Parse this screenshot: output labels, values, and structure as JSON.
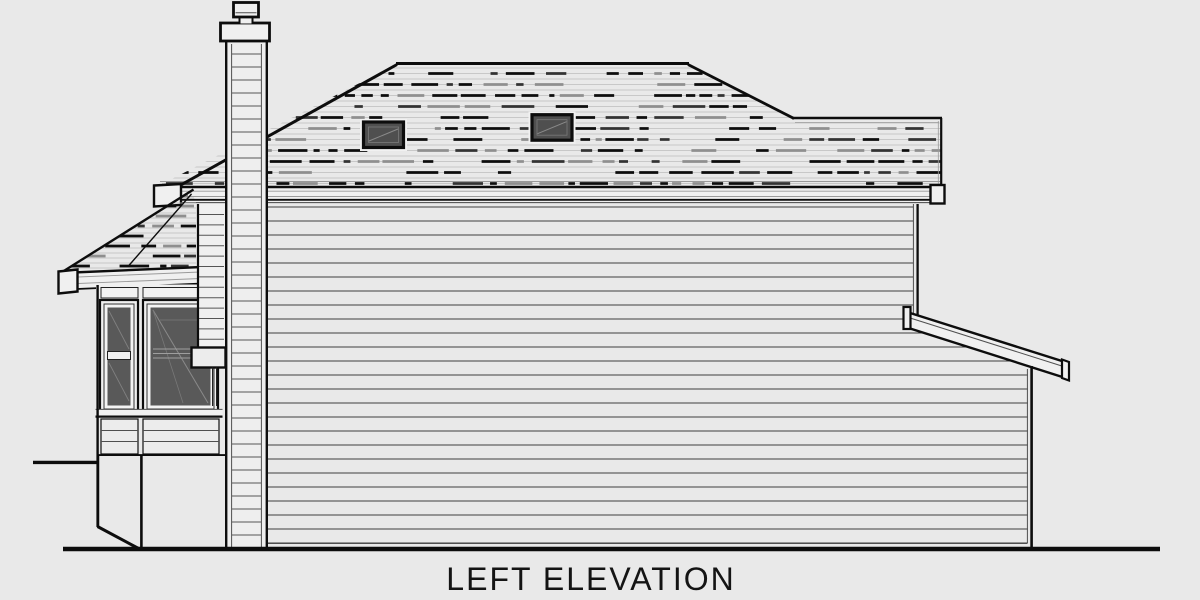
{
  "title": {
    "label": "LEFT ELEVATION"
  },
  "drawing": {
    "type": "architectural-house-side-elevation",
    "elements": [
      "chimney",
      "chimney-cap",
      "chimney-crown",
      "main-hip-roof",
      "roof-shingle-texture",
      "skylight-left",
      "skylight-right",
      "roof-fascia",
      "two-story-siding-wall",
      "bay-window-roof",
      "bay-window",
      "bay-window-left-sash",
      "bay-window-right-sash",
      "downspout-chase",
      "collector-box",
      "rear-shed-roof-beam",
      "single-story-section",
      "grade-line",
      "ground-line"
    ]
  },
  "colors": {
    "bg": "#e9e9e9",
    "line": "#0d0d0d",
    "soft": "#4f4f4f",
    "faint": "#9a9a9a",
    "panel": "#f0f0f0",
    "glass": "#595959",
    "skyglass": "#4f4f4f",
    "texthin": "#bdbdbd",
    "siding": "#3f3f3f",
    "chim": "#eeeeee",
    "ink": "#141414"
  }
}
